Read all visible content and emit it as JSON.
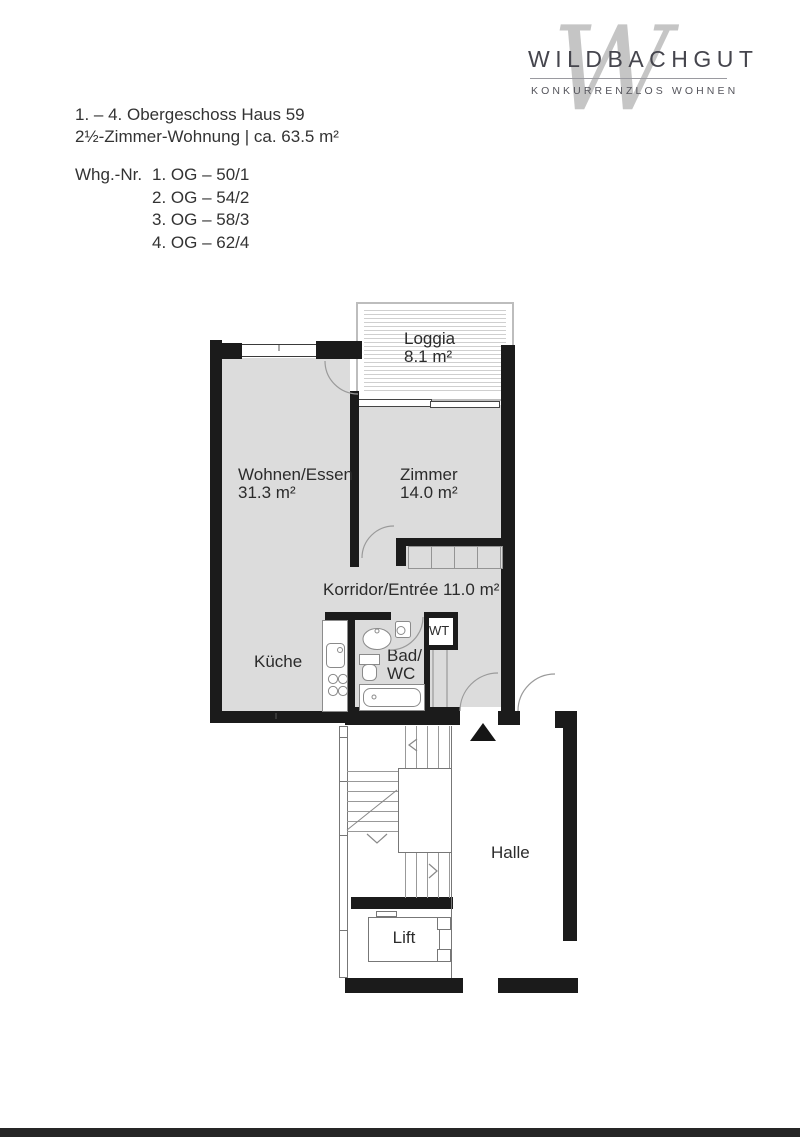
{
  "logo": {
    "brand": "WILDBACHGUT",
    "tagline": "KONKURRENZLOS WOHNEN",
    "watermark": "W"
  },
  "header": {
    "line1": "1. – 4. Obergeschoss Haus 59",
    "line2": "2½-Zimmer-Wohnung | ca. 63.5 m²",
    "whg_label": "Whg.-Nr.",
    "whg_entries": [
      "1. OG – 50/1",
      "2. OG – 54/2",
      "3. OG – 58/3",
      "4. OG – 62/4"
    ]
  },
  "floorplan": {
    "rooms": {
      "loggia": {
        "name": "Loggia",
        "area": "8.1 m²"
      },
      "wohnen": {
        "name": "Wohnen/Essen",
        "area": "31.3 m²"
      },
      "zimmer": {
        "name": "Zimmer",
        "area": "14.0 m²"
      },
      "korridor": {
        "name": "Korridor/Entrée",
        "area": "11.0 m²"
      },
      "kueche": {
        "name": "Küche"
      },
      "bad": {
        "line1": "Bad/",
        "line2": "WC"
      },
      "wt": {
        "name": "WT"
      },
      "halle": {
        "name": "Halle"
      },
      "lift": {
        "name": "Lift"
      }
    },
    "colors": {
      "wall": "#1b1b1b",
      "room_fill": "#dcdcdc",
      "thin_line": "#8c8c8c",
      "accent_text": "#2b2b2b"
    }
  }
}
